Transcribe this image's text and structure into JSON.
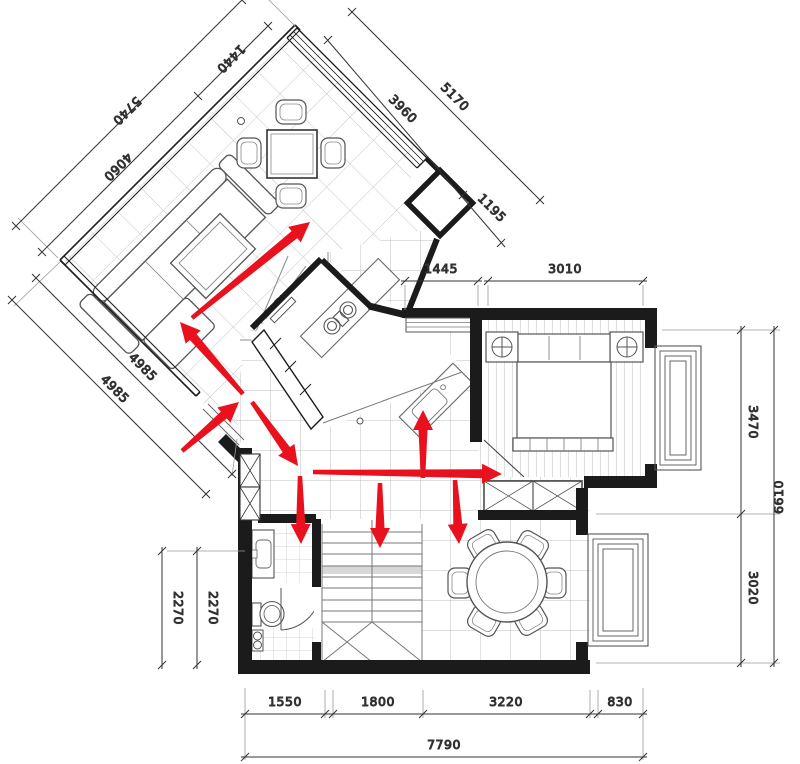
{
  "title": "apartment-floor-plan",
  "colors": {
    "wall": "#1b1b1b",
    "thin_line": "#555555",
    "grid": "#c2c2c2",
    "dimension": "#333333",
    "flow_arrow": "#e8111d"
  },
  "dimensions": {
    "upper_left": {
      "overall": "5740",
      "segments": [
        "4060",
        "1440"
      ]
    },
    "upper_right": {
      "overall": "5170",
      "segments": [
        "3960",
        "1195"
      ]
    },
    "left_diagonal": {
      "inner": "4985",
      "outer": "4985"
    },
    "middle_top": {
      "segments": [
        "1445",
        "3010"
      ]
    },
    "right_side": {
      "overall": "6610",
      "segments": [
        "3470",
        "3020"
      ]
    },
    "left_lower": {
      "segments": [
        "2270",
        "2270"
      ]
    },
    "bottom": {
      "overall": "7790",
      "segments": [
        "1550",
        "1800",
        "3220",
        "830"
      ]
    }
  },
  "labels": {
    "tv": "TV"
  },
  "flow_arrows": [
    {
      "from": [
        192,
        318
      ],
      "to": [
        310,
        222
      ]
    },
    {
      "from": [
        243,
        394
      ],
      "to": [
        180,
        322
      ]
    },
    {
      "from": [
        182,
        451
      ],
      "to": [
        239,
        402
      ]
    },
    {
      "from": [
        252,
        402
      ],
      "to": [
        298,
        466
      ]
    },
    {
      "from": [
        423,
        478
      ],
      "to": [
        423,
        410
      ]
    },
    {
      "from": [
        313,
        472
      ],
      "to": [
        502,
        474
      ]
    },
    {
      "from": [
        300,
        476
      ],
      "to": [
        301,
        544
      ]
    },
    {
      "from": [
        380,
        483
      ],
      "to": [
        380,
        548
      ]
    },
    {
      "from": [
        455,
        480
      ],
      "to": [
        459,
        544
      ]
    }
  ]
}
